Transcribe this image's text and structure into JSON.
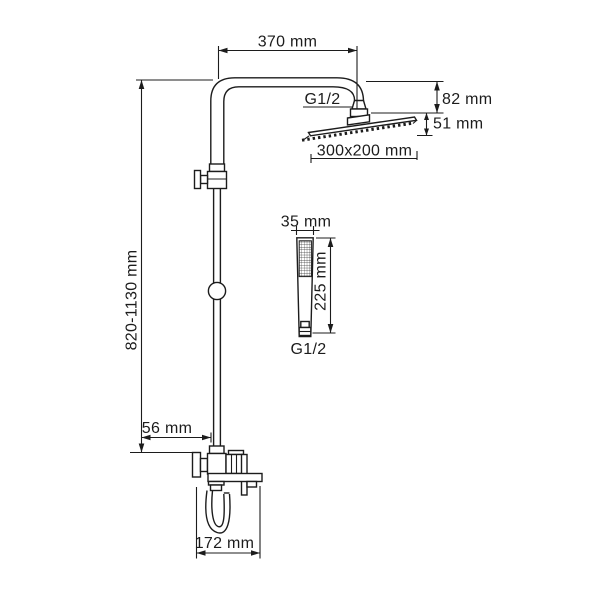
{
  "colors": {
    "line": "#1c1c1c",
    "background": "#ffffff"
  },
  "labels": {
    "arm_length": "370 mm",
    "head_thread": "G1/2",
    "head_drop": "82 mm",
    "head_depth": "51 mm",
    "head_size": "300x200 mm",
    "handshower_width": "35 mm",
    "handshower_length": "225 mm",
    "handshower_thread": "G1/2",
    "riser_height": "820-1130 mm",
    "wall_offset": "56 mm",
    "mixer_width": "172 mm"
  }
}
